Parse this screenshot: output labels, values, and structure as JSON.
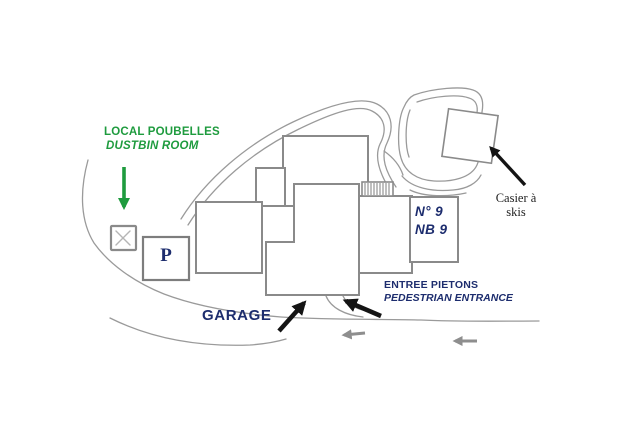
{
  "labels": {
    "dustbin": {
      "fr": "LOCAL POUBELLES",
      "en": "DUSTBIN ROOM"
    },
    "parking": "P",
    "building_number": {
      "line1": "N° 9",
      "line2": "NB 9"
    },
    "garage": "GARAGE",
    "pedestrian_entrance": {
      "fr": "ENTREE PIETONS",
      "en": "PEDESTRIAN ENTRANCE"
    },
    "ski_locker": {
      "line1": "Casier à",
      "line2": "skis"
    }
  },
  "colors": {
    "label_green": "#1e9b3e",
    "label_navy": "#1d2d6e",
    "ink": "#1f1f1f",
    "outline": "#8a8a8a",
    "road": "#9a9a9a",
    "arrow_black": "#141414",
    "arrow_gray": "#8e8e8e"
  }
}
